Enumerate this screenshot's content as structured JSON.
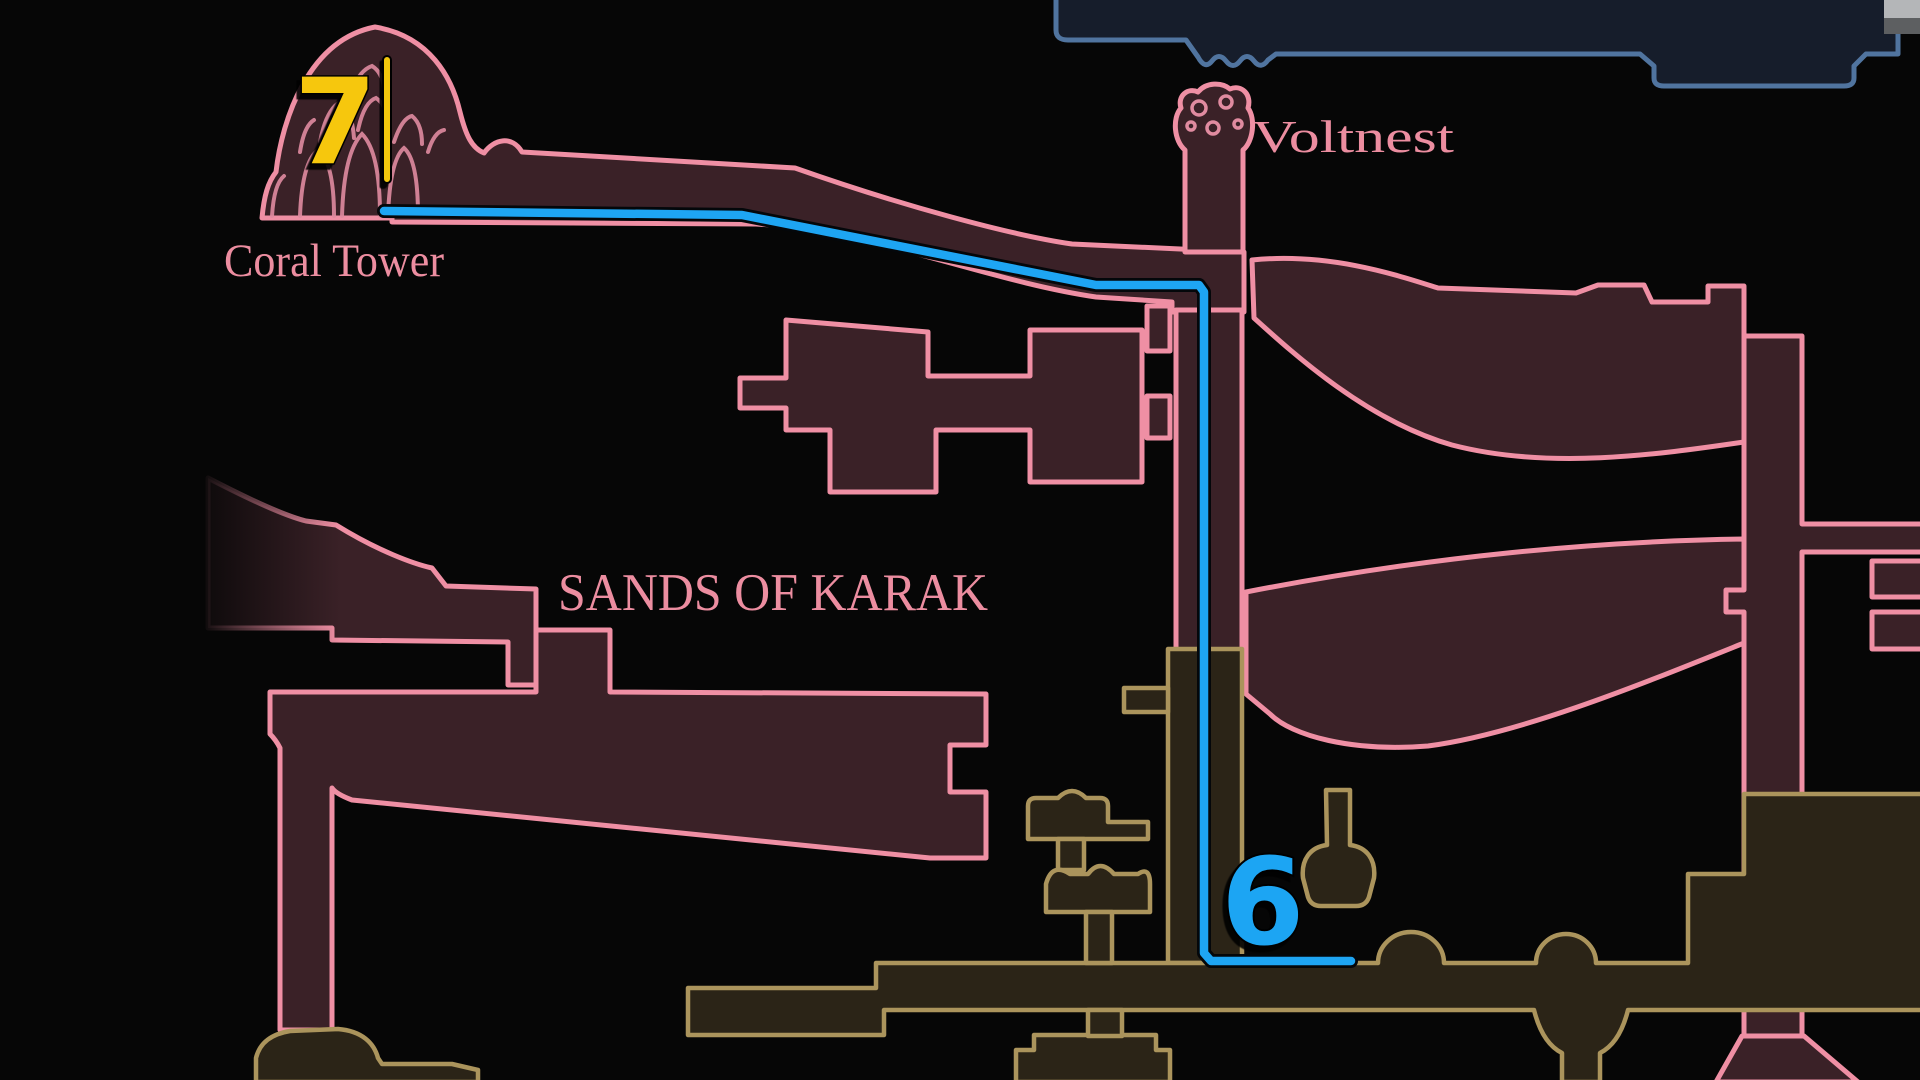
{
  "labels": {
    "coral_tower": "Coral Tower",
    "voltnest": "Voltnest",
    "sands_of_karak": "SANDS OF KARAK"
  },
  "markers": {
    "m7": {
      "label": "7",
      "color": "#f6c70a"
    },
    "m6": {
      "label": "6",
      "color": "#1ea5f3"
    }
  },
  "route": {
    "points": "384,211 742,215 1096,285 1199,285 1204,292 1204,953 1211,961 1351,961",
    "color": "#1ea5f3"
  },
  "colors": {
    "background": "#060606",
    "pink_outline": "#ef8fa4",
    "pink_fill": "#3a2127",
    "olive_outline": "#ab945c",
    "olive_fill": "#2b2417",
    "navy_outline": "#50749f",
    "navy_fill": "#161d2b",
    "label_text": "#ec8da0",
    "gray_block_top": "#b4b6b8",
    "gray_block_bottom": "#5d5f61"
  }
}
